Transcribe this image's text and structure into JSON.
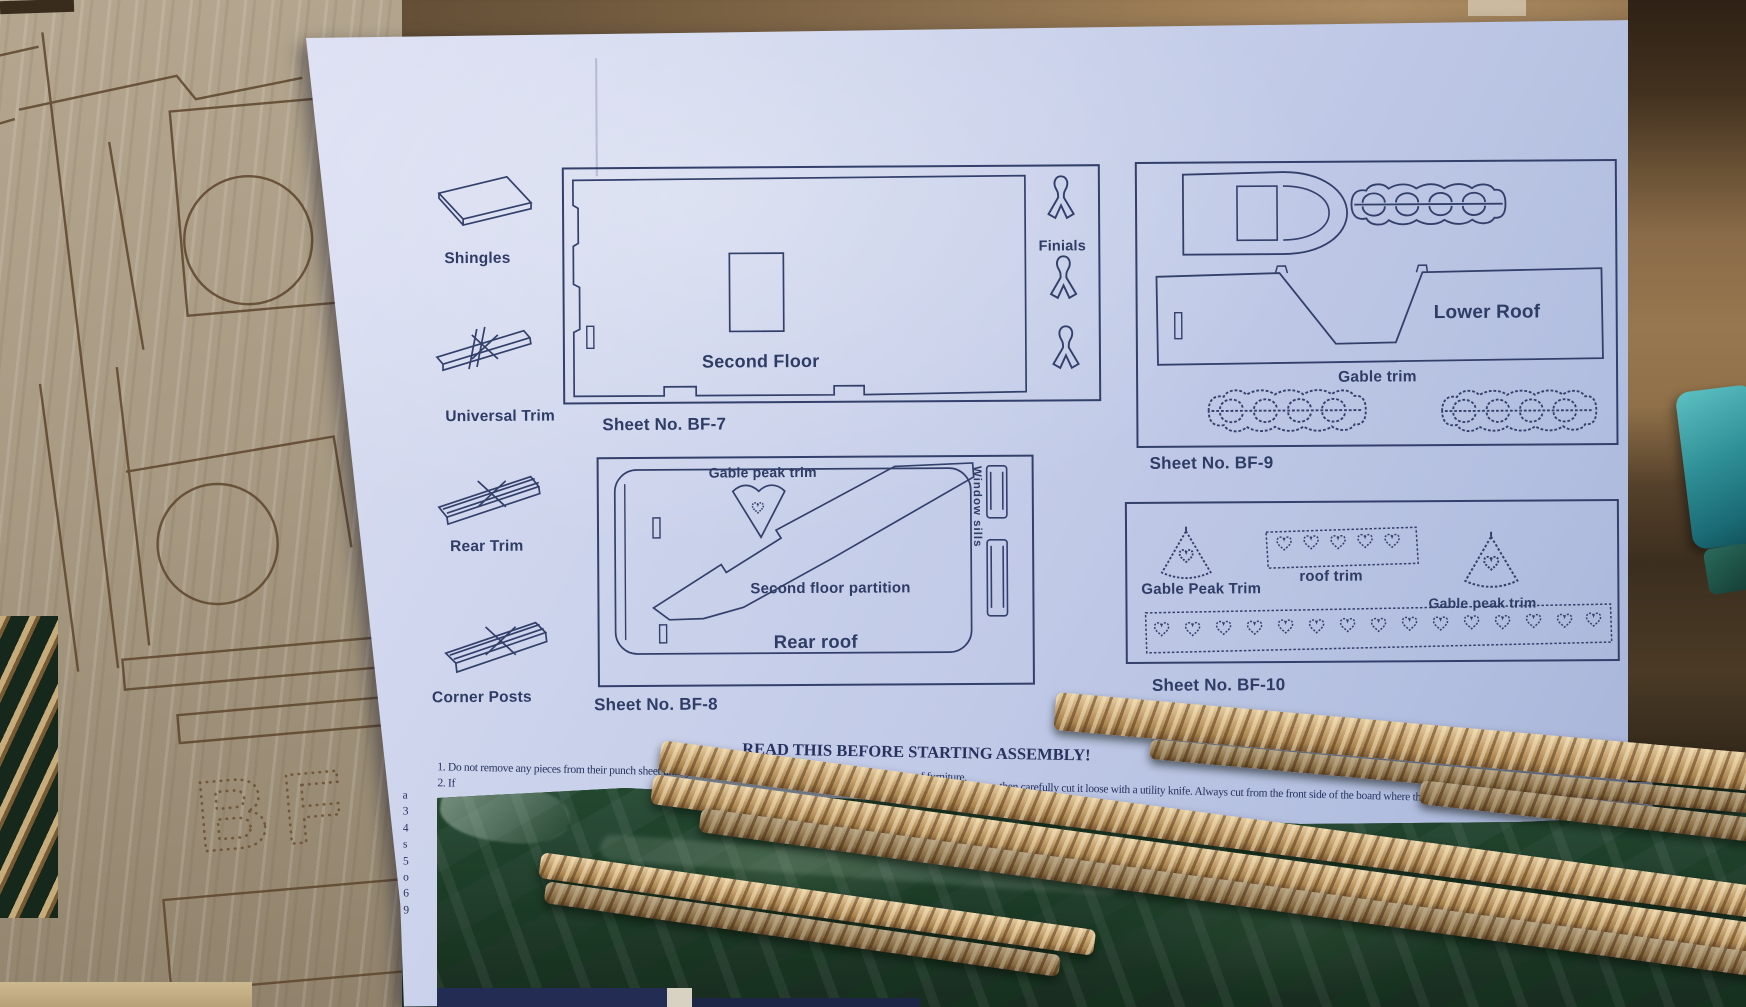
{
  "legend": {
    "items": [
      {
        "label": "Shingles"
      },
      {
        "label": "Universal Trim"
      },
      {
        "label": "Rear Trim"
      },
      {
        "label": "Corner Posts"
      }
    ]
  },
  "sheets": {
    "bf7": {
      "caption": "Sheet No. BF-7",
      "second_floor": "Second Floor",
      "finials": "Finials"
    },
    "bf8": {
      "caption": "Sheet No. BF-8",
      "gable_peak_trim": "Gable peak trim",
      "window_sills": "Window sills",
      "second_floor_partition": "Second floor partition",
      "rear_roof": "Rear roof"
    },
    "bf9": {
      "caption": "Sheet No. BF-9",
      "lower_roof": "Lower Roof",
      "gable_trim": "Gable trim"
    },
    "bf10": {
      "caption": "Sheet No. BF-10",
      "gable_peak_trim_left": "Gable Peak Trim",
      "roof_trim": "roof trim",
      "gable_peak_trim_right": "Gable peak trim"
    }
  },
  "instructions": {
    "heading": "READ THIS BEFORE STARTING ASSEMBLY!",
    "line1": "1. Do not remove any pieces from their punch sheet until you are ready to begin assembling that specific piece of furniture.",
    "line2_start": "2. If",
    "line2_visible": "then carefully cut it loose with a utility knife. Always cut from the front side of the board where the cut lin",
    "margin_chars": [
      "a",
      "3",
      "4",
      "s",
      "5",
      "o",
      "6",
      "9"
    ]
  },
  "board": {
    "punched_text": "BF"
  },
  "colors": {
    "ink": "#2e3c66",
    "paper_light": "#dde0f3",
    "paper_dark": "#a5b1d6",
    "board_wood": "#a79a85",
    "top_wood": "#8a6c49",
    "green_box": "#22402d",
    "stick": "#cdab79",
    "teal_object": "#2f8f96",
    "bottom_navy": "#232c52"
  }
}
